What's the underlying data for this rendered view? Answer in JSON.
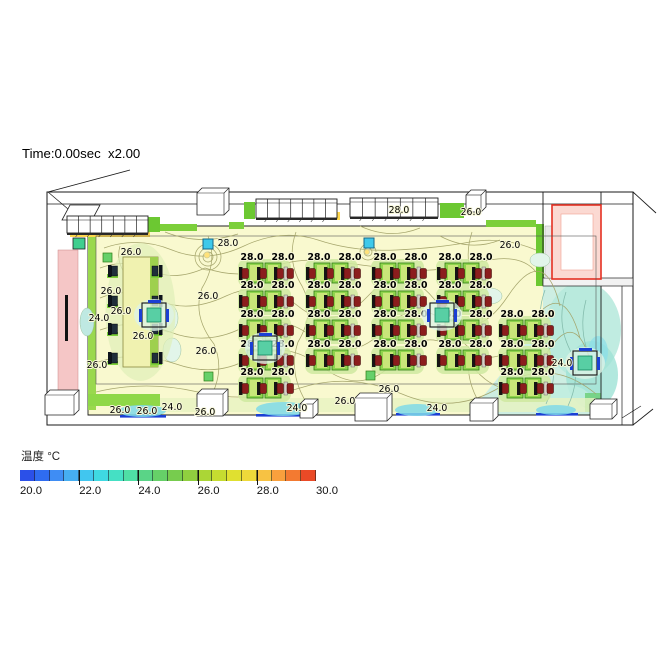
{
  "header": {
    "time_label": "Time:0.00sec  x2.00"
  },
  "legend": {
    "title": "温度 °C",
    "ticks": [
      "20.0",
      "22.0",
      "24.0",
      "26.0",
      "28.0",
      "30.0"
    ],
    "colors": [
      "#2b50e8",
      "#2f6cf0",
      "#3f8df4",
      "#46aef2",
      "#41c6ef",
      "#3fd9e2",
      "#45e0c4",
      "#4fdfa5",
      "#5ad487",
      "#66d068",
      "#77cc4e",
      "#90cf3f",
      "#abd636",
      "#c6dc30",
      "#e0e030",
      "#eed93a",
      "#f7c243",
      "#f9a03d",
      "#f37a31",
      "#ea4a26"
    ]
  },
  "chart_data": {
    "type": "heatmap",
    "title": "Time:0.00sec  x2.00",
    "colorbar_label": "温度 °C",
    "value_range": [
      20.0,
      30.0
    ],
    "colorbar_tick_values": [
      20.0,
      22.0,
      24.0,
      26.0,
      28.0,
      30.0
    ],
    "contour_interval": 2.0,
    "contour_labels": [
      {
        "value": 26.0,
        "x": 131,
        "y": 255
      },
      {
        "value": 28.0,
        "x": 228,
        "y": 246
      },
      {
        "value": 26.0,
        "x": 208,
        "y": 299
      },
      {
        "value": 26.0,
        "x": 111,
        "y": 294
      },
      {
        "value": 26.0,
        "x": 121,
        "y": 314
      },
      {
        "value": 24.0,
        "x": 99,
        "y": 321
      },
      {
        "value": 26.0,
        "x": 143,
        "y": 339
      },
      {
        "value": 26.0,
        "x": 97,
        "y": 368
      },
      {
        "value": 26.0,
        "x": 206,
        "y": 354
      },
      {
        "value": 28.0,
        "x": 399,
        "y": 213
      },
      {
        "value": 26.0,
        "x": 471,
        "y": 215
      },
      {
        "value": 26.0,
        "x": 510,
        "y": 248
      },
      {
        "value": 24.0,
        "x": 562,
        "y": 366
      },
      {
        "value": 26.0,
        "x": 120,
        "y": 413
      },
      {
        "value": 26.0,
        "x": 147,
        "y": 414
      },
      {
        "value": 24.0,
        "x": 172,
        "y": 410
      },
      {
        "value": 26.0,
        "x": 205,
        "y": 415
      },
      {
        "value": 24.0,
        "x": 297,
        "y": 411
      },
      {
        "value": 26.0,
        "x": 345,
        "y": 404
      },
      {
        "value": 26.0,
        "x": 389,
        "y": 392
      },
      {
        "value": 24.0,
        "x": 437,
        "y": 411
      }
    ],
    "desk_cluster_label_value": 28.0
  },
  "scene": {
    "cluster_label": "28.0",
    "clusters": [
      [
        247,
        263
      ],
      [
        247,
        291
      ],
      [
        247,
        320
      ],
      [
        247,
        350
      ],
      [
        247,
        378
      ],
      [
        314,
        263
      ],
      [
        314,
        291
      ],
      [
        314,
        320
      ],
      [
        314,
        350
      ],
      [
        380,
        263
      ],
      [
        380,
        291
      ],
      [
        380,
        320
      ],
      [
        380,
        350
      ],
      [
        445,
        263
      ],
      [
        445,
        291
      ],
      [
        445,
        320
      ],
      [
        445,
        350
      ],
      [
        507,
        320
      ],
      [
        507,
        350
      ],
      [
        507,
        378
      ]
    ],
    "sensors": [
      [
        203,
        239
      ],
      [
        364,
        238
      ]
    ],
    "units": [
      [
        142,
        303
      ],
      [
        253,
        336
      ],
      [
        430,
        303
      ],
      [
        573,
        351
      ]
    ],
    "green_markers": [
      [
        103,
        253
      ],
      [
        204,
        372
      ],
      [
        366,
        371
      ]
    ],
    "wall_marker": [
      73,
      238
    ],
    "vents": [
      [
        67,
        216,
        81,
        17
      ],
      [
        256,
        199,
        81,
        19
      ],
      [
        350,
        198,
        88,
        19
      ]
    ],
    "white_boxes_top": [
      [
        197,
        188,
        32,
        27
      ],
      [
        466,
        190,
        20,
        22
      ]
    ],
    "white_boxes_bottom": [
      [
        45,
        390,
        34,
        25
      ],
      [
        197,
        389,
        31,
        27
      ],
      [
        300,
        399,
        18,
        19
      ],
      [
        355,
        393,
        37,
        28
      ],
      [
        470,
        398,
        28,
        23
      ],
      [
        590,
        399,
        27,
        20
      ]
    ],
    "floor_vent_lines": [
      [
        120,
        415,
        46
      ],
      [
        256,
        414,
        52
      ],
      [
        396,
        413,
        44
      ],
      [
        536,
        413,
        42
      ]
    ],
    "cool_blobs": [
      [
        142,
        411,
        24,
        6
      ],
      [
        283,
        409,
        27,
        7
      ],
      [
        417,
        410,
        22,
        6
      ],
      [
        556,
        410,
        20,
        5
      ]
    ],
    "teacher": {
      "desk": [
        123,
        257,
        35,
        110
      ],
      "chairs_left_x": 108,
      "chairs_right_x": 152,
      "chairs_y": [
        265,
        295,
        323,
        352
      ]
    }
  }
}
